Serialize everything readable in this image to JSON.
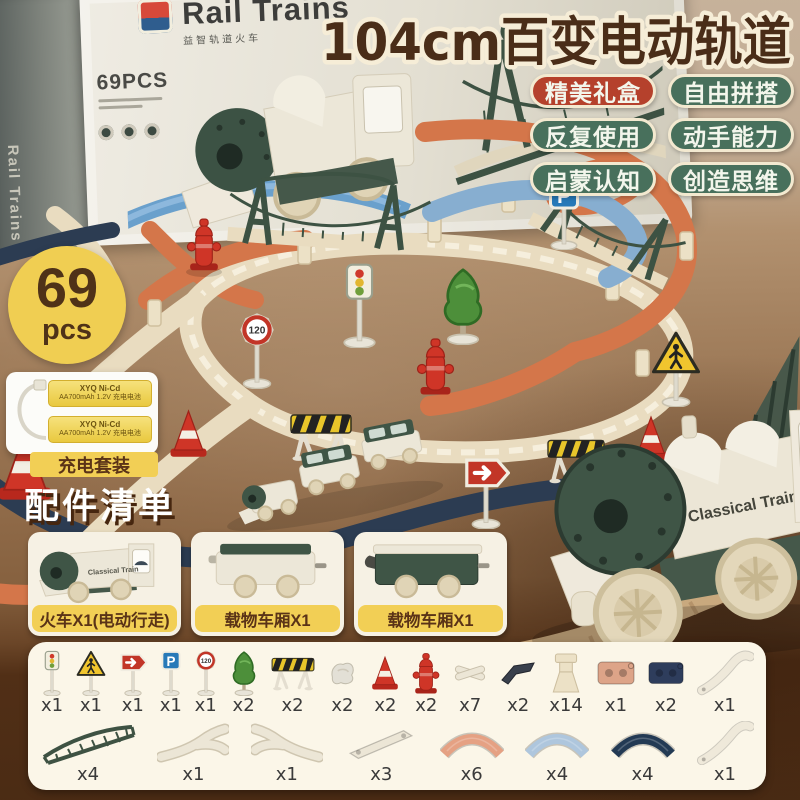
{
  "header": {
    "title": "104cm百变电动轨道",
    "badges": [
      {
        "label": "精美礼盒",
        "color": "#b5412c"
      },
      {
        "label": "自由拼搭",
        "color": "#48705c"
      },
      {
        "label": "反复使用",
        "color": "#48705c"
      },
      {
        "label": "动手能力",
        "color": "#48705c"
      },
      {
        "label": "启蒙认知",
        "color": "#48705c"
      },
      {
        "label": "创造思维",
        "color": "#48705c"
      }
    ]
  },
  "box": {
    "title": "Rail Trains",
    "subtitle": "益智轨道火车",
    "pieces": "69PCS"
  },
  "count_badge": {
    "number": "69",
    "unit": "pcs",
    "bg": "#f0ce52"
  },
  "battery": {
    "label": "充电套装",
    "cell_line1": "XYQ Ni-Cd",
    "cell_line2": "AA700mAh 1.2V 充电电池"
  },
  "accessories": {
    "title": "配件清单",
    "vehicles": [
      {
        "label": "火车X1(电动行走)"
      },
      {
        "label": "载物车厢X1"
      },
      {
        "label": "载物车厢X1"
      }
    ]
  },
  "train_branding": "Classical Train",
  "scene": {
    "parking_letter": "P",
    "speed_sign": "120"
  },
  "parts": {
    "row1": [
      {
        "icon": "traffic-light",
        "count": "x1",
        "w": 24
      },
      {
        "icon": "crossing-sign",
        "count": "x1",
        "w": 32
      },
      {
        "icon": "arrow-sign",
        "count": "x1",
        "w": 30
      },
      {
        "icon": "parking-sign",
        "count": "x1",
        "w": 24
      },
      {
        "icon": "speed-sign",
        "count": "x1",
        "w": 24
      },
      {
        "icon": "tree",
        "count": "x2",
        "w": 30
      },
      {
        "icon": "barrier",
        "count": "x2",
        "w": 46
      },
      {
        "icon": "white-marker",
        "count": "x2",
        "w": 32
      },
      {
        "icon": "cone",
        "count": "x2",
        "w": 32
      },
      {
        "icon": "hydrant",
        "count": "x2",
        "w": 28
      },
      {
        "icon": "track-clip",
        "count": "x7",
        "w": 38,
        "color": "#ece6d6"
      },
      {
        "icon": "track-piece-dark",
        "count": "x2",
        "w": 36,
        "color": "#39404c"
      },
      {
        "icon": "track-support",
        "count": "x14",
        "w": 38,
        "color": "#ece1c6"
      },
      {
        "icon": "track-short",
        "count": "x1",
        "w": 40,
        "color": "#dda488"
      },
      {
        "icon": "track-short",
        "count": "x2",
        "w": 38,
        "color": "#2e3d5c"
      },
      {
        "icon": "track-long",
        "count": "x1",
        "w": 58,
        "color": "#efe9da"
      }
    ],
    "row2": [
      {
        "icon": "bridge-truss",
        "count": "x4",
        "w": 96,
        "color": "#3e5243"
      },
      {
        "icon": "track-switch",
        "count": "x1",
        "w": 72,
        "color": "#ece6d6"
      },
      {
        "icon": "track-switch-alt",
        "count": "x1",
        "w": 72,
        "color": "#ece6d6"
      },
      {
        "icon": "track-straight",
        "count": "x3",
        "w": 74,
        "color": "#ece6d6"
      },
      {
        "icon": "track-curve",
        "count": "x6",
        "w": 64,
        "color": "#e5a183"
      },
      {
        "icon": "track-curve",
        "count": "x4",
        "w": 64,
        "color": "#aec6dd"
      },
      {
        "icon": "track-curve",
        "count": "x4",
        "w": 64,
        "color": "#233a54"
      },
      {
        "icon": "track-long",
        "count": "x1",
        "w": 58,
        "color": "#efe9da"
      }
    ]
  },
  "colors": {
    "accent_yellow": "#f0ce52",
    "badge_red": "#b5412c",
    "badge_green": "#48705c",
    "title_brown": "#4a2d18",
    "title_outline": "#f6edd7",
    "panel_cream": "#fbf6e8",
    "floor_brown": "#946f4d",
    "dark_band": "#4a2b14",
    "track_white": "#e9dcc0",
    "track_orange": "#d4764a",
    "track_blue": "#87aed0",
    "track_navy": "#2c3c52",
    "bridge_green": "#3d5243",
    "train_green": "#3f5546"
  }
}
